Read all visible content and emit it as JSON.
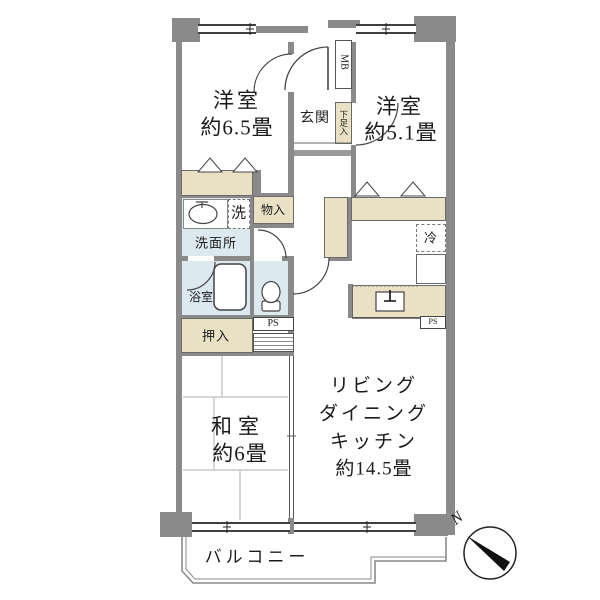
{
  "title": "apartment floor plan",
  "colors": {
    "wall": "#8a8a8a",
    "closet_fill": "#eae1c5",
    "wet_area_fill": "#dce9f1",
    "line": "#444444"
  },
  "rooms": {
    "bedroom1": {
      "name": "洋室",
      "size": "約6.5畳"
    },
    "bedroom2": {
      "name": "洋室",
      "size": "約5.1畳"
    },
    "japanese_room": {
      "name": "和室",
      "size": "約6畳"
    },
    "ldk": {
      "line1": "リビング",
      "line2": "ダイニング",
      "line3": "キッチン",
      "size": "約14.5畳"
    },
    "entrance": "玄関",
    "washroom": "洗面所",
    "bath": "浴室",
    "balcony": "バルコニー"
  },
  "fixtures": {
    "shoe_cabinet": "下足入",
    "meter_box": "MB",
    "washer": "洗",
    "storage": "物入",
    "closet": "押入",
    "pipe_space_1": "PS",
    "pipe_space_2": "PS",
    "refrigerator": "冷"
  },
  "compass": {
    "north": "N"
  }
}
